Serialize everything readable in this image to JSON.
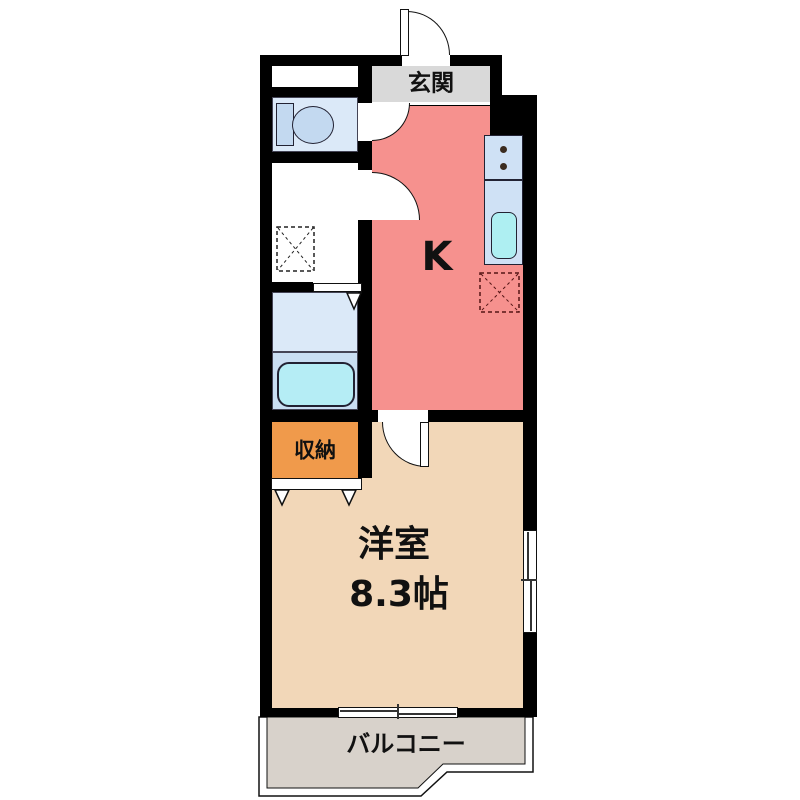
{
  "floorplan": {
    "rooms": {
      "entrance": {
        "label": "玄関",
        "color": "#d9d9d9"
      },
      "kitchen": {
        "label": "K",
        "color": "#f6918e"
      },
      "toilet_room": {
        "color": "#dbe9f8"
      },
      "washroom": {
        "color": "#ffffff"
      },
      "bathroom": {
        "color_upper": "#dbe9f8",
        "color_lower": "#c9def2"
      },
      "storage": {
        "label": "収納",
        "color": "#f09a4b"
      },
      "western_room": {
        "label": "洋室",
        "size": "8.3帖",
        "color": "#f2d7b8"
      },
      "balcony": {
        "label": "バルコニー",
        "color": "#d8d2cb"
      }
    },
    "fixtures": {
      "toilet": "toilet",
      "washing_machine_space": "washing-machine-space",
      "bathtub": "bathtub",
      "stove": "stove-2-burner",
      "sink": "sink",
      "refrigerator_space": "refrigerator-space"
    },
    "colors": {
      "wall": "#000000",
      "fixture_blue": "#c3d9f0",
      "tub_cyan": "#b5edf5",
      "counter_blue": "#cfe1f5",
      "sink_cyan": "#aeeff2"
    }
  }
}
